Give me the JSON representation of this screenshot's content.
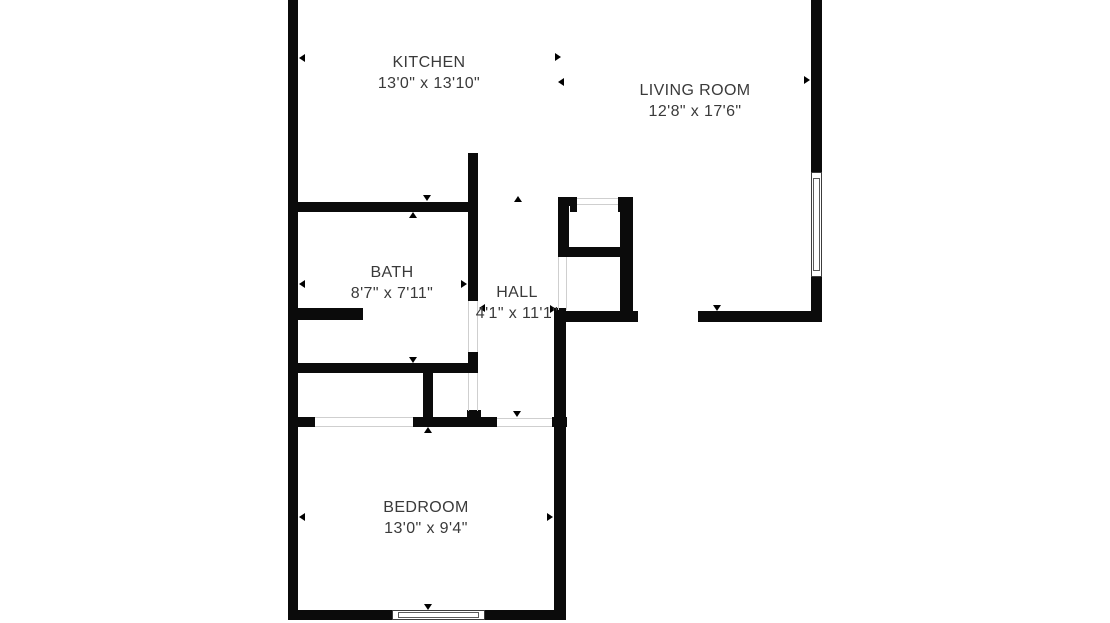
{
  "colors": {
    "wall": "#0b0b0b",
    "background": "#ffffff",
    "text": "#3a3a3a"
  },
  "rooms": [
    {
      "id": "kitchen",
      "name": "KITCHEN",
      "dimensions": "13'0\" x 13'10\""
    },
    {
      "id": "living-room",
      "name": "LIVING ROOM",
      "dimensions": "12'8\" x 17'6\""
    },
    {
      "id": "bath",
      "name": "BATH",
      "dimensions": "8'7\" x 7'11\""
    },
    {
      "id": "hall",
      "name": "HALL",
      "dimensions": "4'1\" x 11'1\""
    },
    {
      "id": "bedroom",
      "name": "BEDROOM",
      "dimensions": "13'0\" x 9'4\""
    }
  ]
}
